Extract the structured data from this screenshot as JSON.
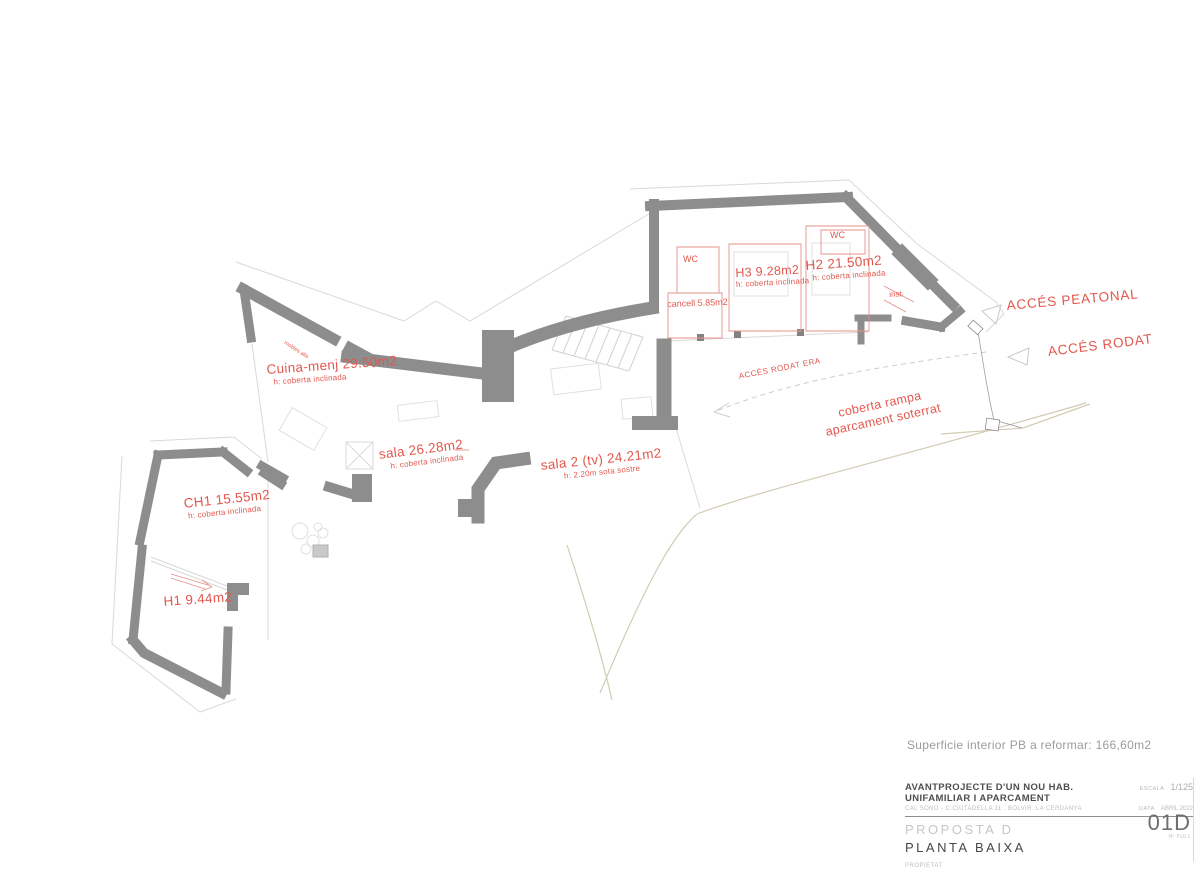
{
  "rooms": [
    {
      "name": "Cuina-menj 29.50m2",
      "sub": "h: coberta inclinada"
    },
    {
      "name": "sala 26.28m2",
      "sub": "h: coberta inclinada"
    },
    {
      "name": "sala 2 (tv) 24.21m2",
      "sub": "h: 2.20m sota sostre"
    },
    {
      "name": "CH1 15.55m2",
      "sub": "h: coberta inclinada"
    },
    {
      "name": "H1 9.44m2",
      "sub": ""
    },
    {
      "name": "H3 9.28m2",
      "sub": "h: coberta inclinada"
    },
    {
      "name": "H2 21.50m2",
      "sub": "h: coberta inclinada"
    },
    {
      "name": "cancell 5.85m2",
      "sub": ""
    },
    {
      "name": "WC",
      "sub": ""
    },
    {
      "name": "WC",
      "sub": ""
    },
    {
      "name": "inst.",
      "sub": ""
    },
    {
      "name": "mobles alts",
      "sub": ""
    }
  ],
  "access": {
    "peatonal": "ACCÉS PEATONAL",
    "rodat": "ACCÉS RODAT",
    "era": "ACCÉS RODAT ERA",
    "rampa_line1": "coberta rampa",
    "rampa_line2": "aparcament soterrat"
  },
  "summary": "Superficie interior PB a reformar: 166,60m2",
  "titleblock": {
    "project": "AVANTPROJECTE D'UN NOU HAB. UNIFAMILIAR I APARCAMENT",
    "address": "CAL SONO - C.CIUTADELLA 11 . BOLVIR. LA CERDANYA",
    "scale_label": "ESCALA",
    "scale_value": "1/125",
    "date_label": "DATA",
    "date_value": "ABRIL 2022",
    "proposal": "PROPOSTA D",
    "sheet_title": "PLANTA BAIXA",
    "sheet_number": "01D",
    "sheet_number_sub": "Nº FULL",
    "owner_label": "PROPIETAT"
  },
  "colors": {
    "wall_gray": "#8d8d8d",
    "label_red": "#e2574d",
    "partition_red": "#e59189",
    "existing_light": "#d9d9d9",
    "terrain_tan": "#d2cbb4"
  }
}
